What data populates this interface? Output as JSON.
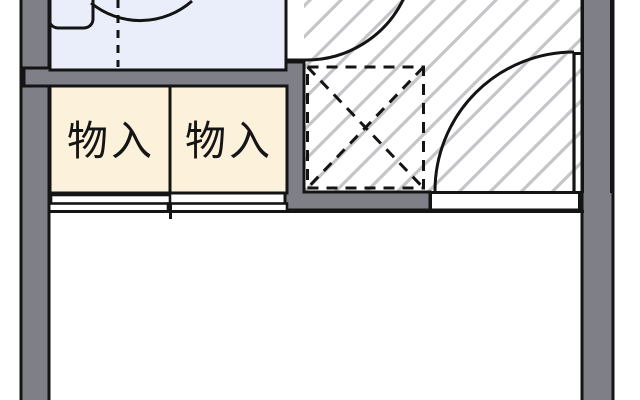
{
  "plan": {
    "kind": "japanese-apartment-floor-plan",
    "labels": {
      "closet_left": "物入",
      "closet_right": "物入"
    },
    "colors": {
      "wall": "#7f7f87",
      "room_blue": "#e9eefa",
      "closet": "#fcf2db",
      "hatch_line": "#c5c5c9",
      "line": "#141414",
      "floor": "#ffffff"
    }
  }
}
